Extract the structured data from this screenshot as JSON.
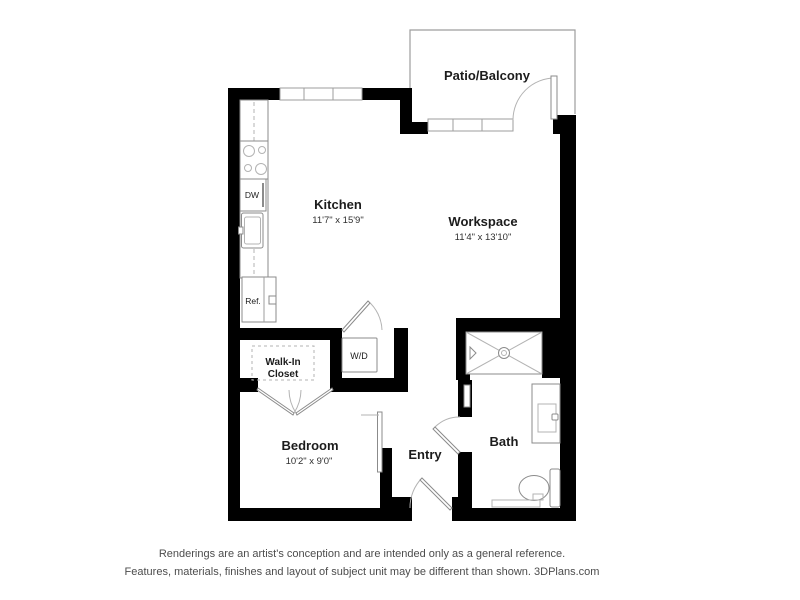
{
  "colors": {
    "bg": "#ffffff",
    "wall": "#000000",
    "thin": "#9d9d9d",
    "fixture": "#8b8b8b",
    "soft": "#b3b3b3",
    "text": "#1c1c1c",
    "dim_text": "#2e2e2e",
    "disclaimer": "#4c4c4c"
  },
  "rooms": {
    "patio": {
      "label": "Patio/Balcony"
    },
    "kitchen": {
      "label": "Kitchen",
      "dimensions": "11'7\" x 15'9\""
    },
    "workspace": {
      "label": "Workspace",
      "dimensions": "11'4\" x 13'10\""
    },
    "bedroom": {
      "label": "Bedroom",
      "dimensions": "10'2\" x 9'0\""
    },
    "bath": {
      "label": "Bath"
    },
    "entry": {
      "label": "Entry"
    },
    "walk_in_closet": {
      "line1": "Walk-In",
      "line2": "Closet"
    }
  },
  "fixtures": {
    "dishwasher": "DW",
    "refrigerator": "Ref.",
    "washer_dryer": "W/D"
  },
  "disclaimer": {
    "line1": "Renderings are an artist's conception and are intended only as a general reference.",
    "line2": "Features, materials, finishes and layout of subject unit may be different than shown. 3DPlans.com"
  }
}
